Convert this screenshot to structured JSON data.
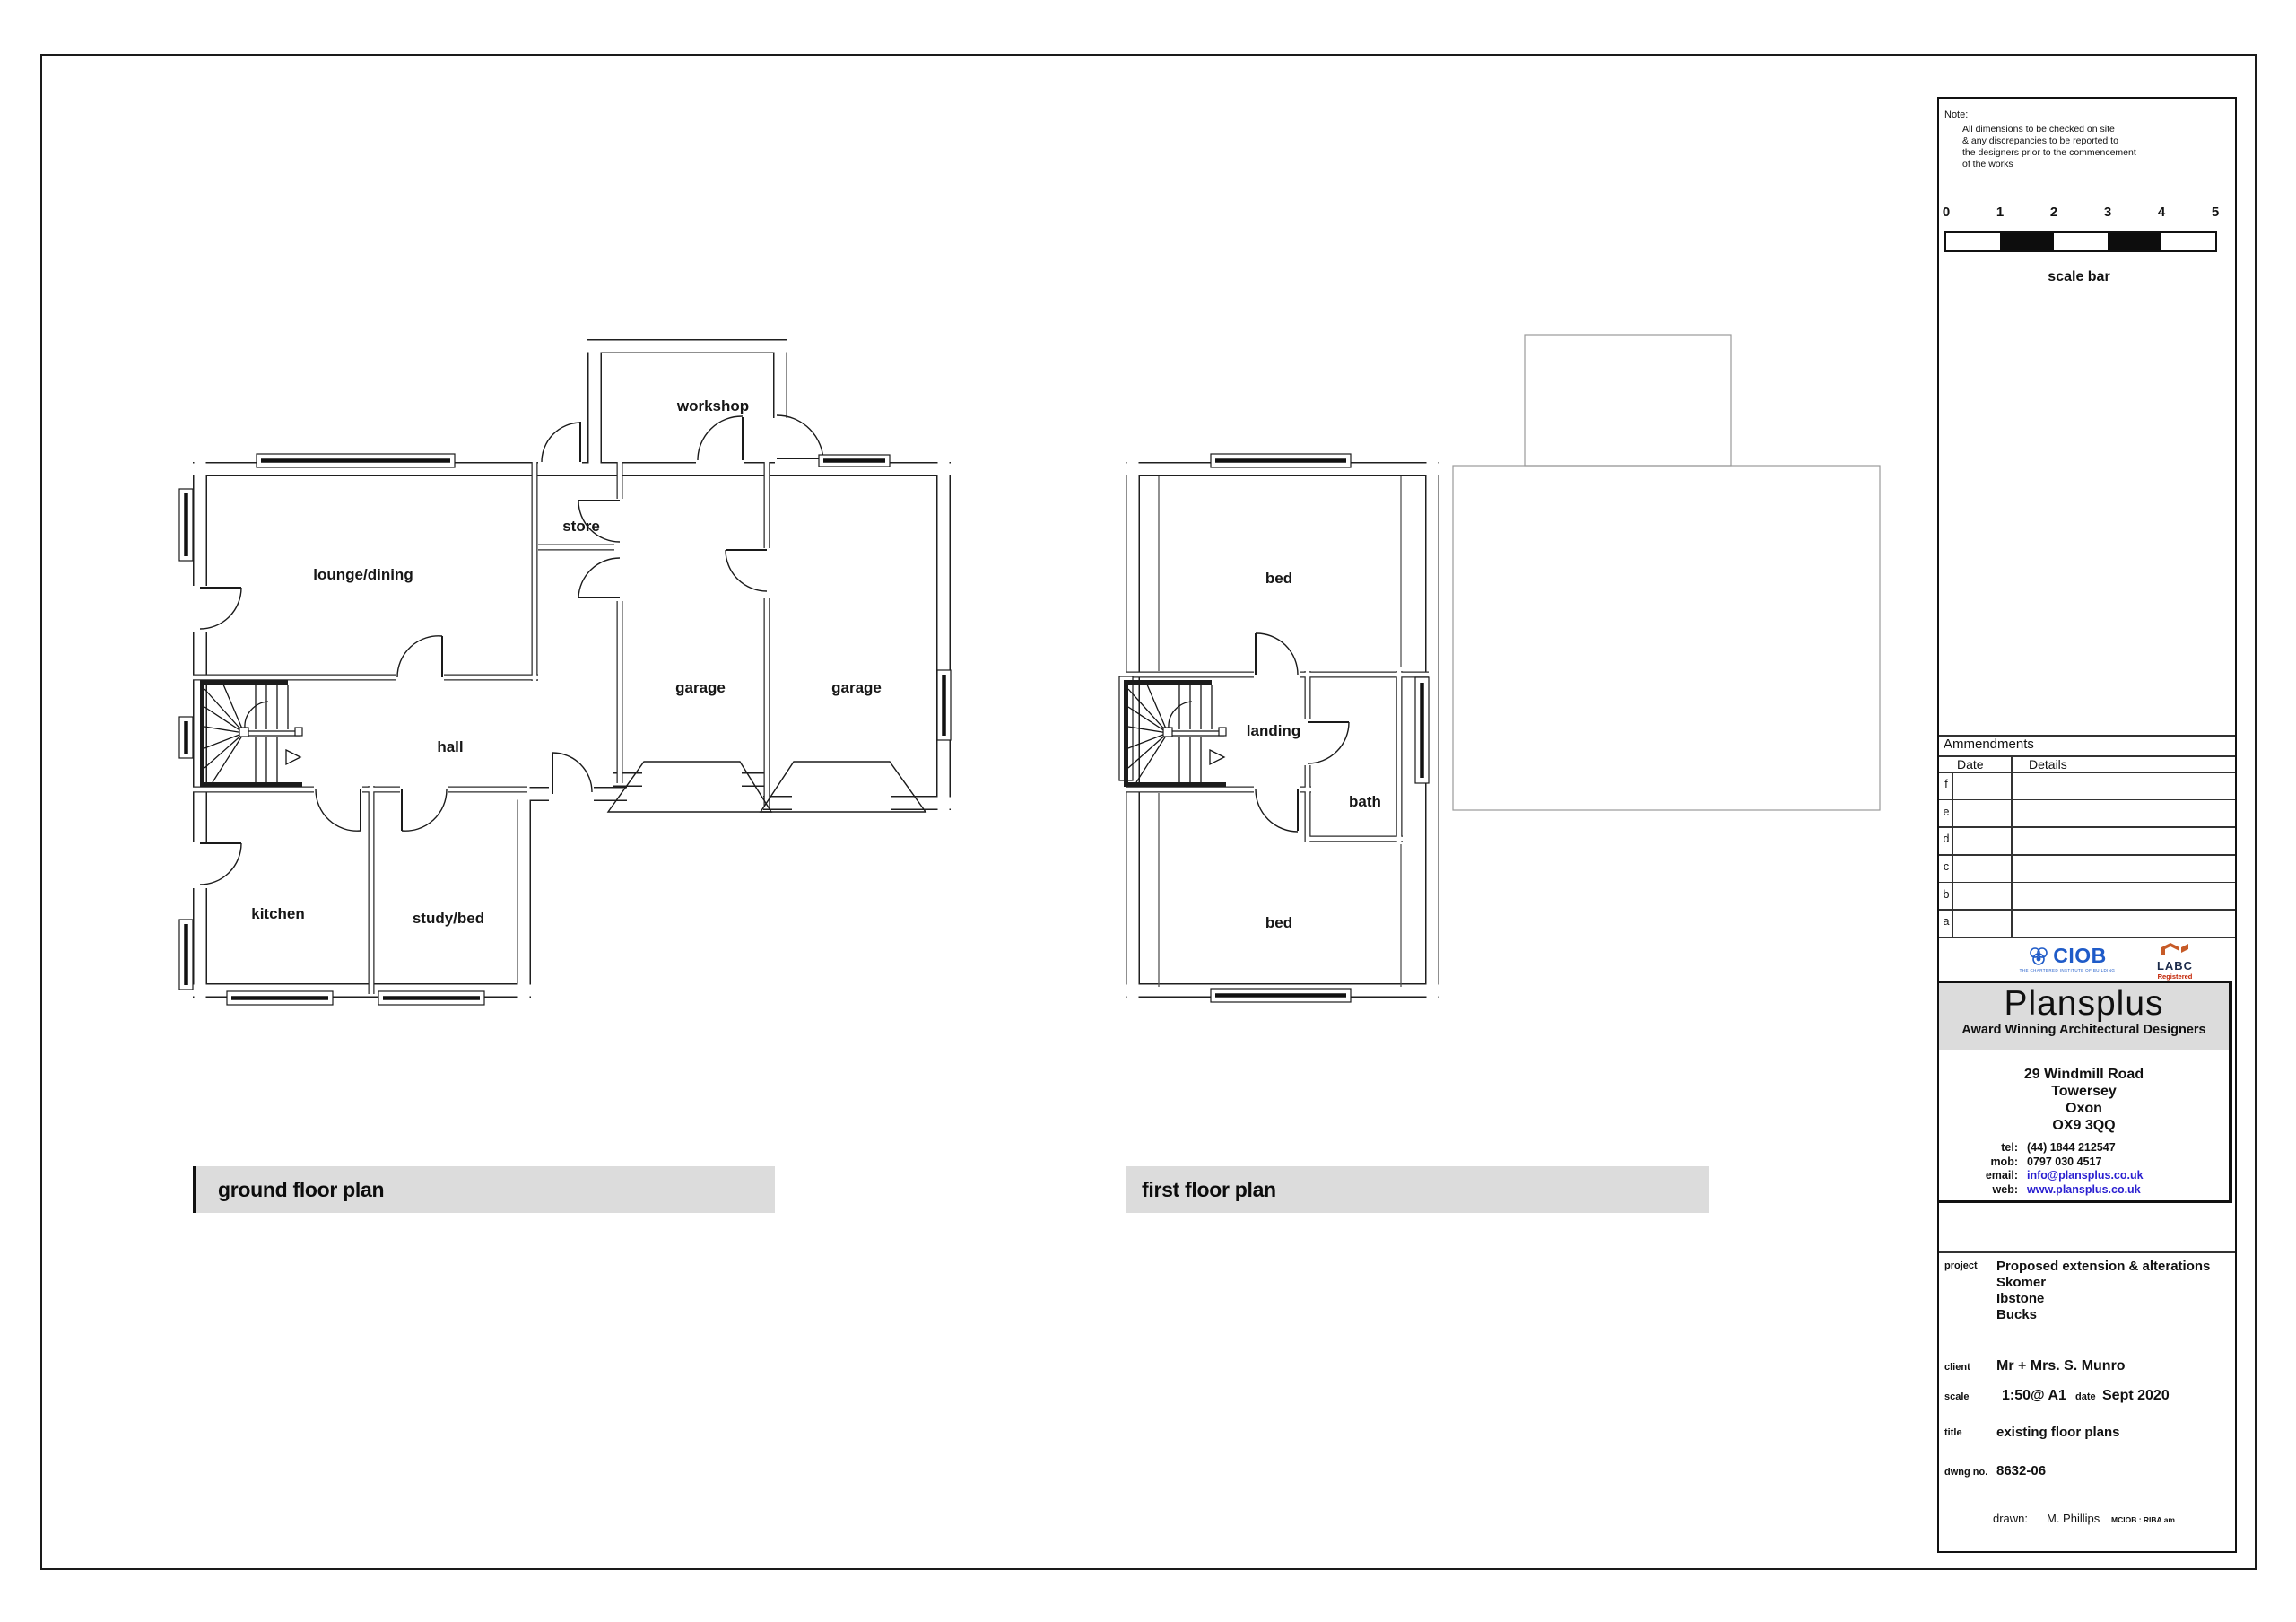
{
  "ground_floor": {
    "title": "ground floor plan",
    "rooms": {
      "lounge_dining": "lounge/dining",
      "workshop": "workshop",
      "store": "store",
      "garage_left": "garage",
      "garage_right": "garage",
      "hall": "hall",
      "kitchen": "kitchen",
      "study_bed": "study/bed"
    }
  },
  "first_floor": {
    "title": "first floor plan",
    "rooms": {
      "bed_top": "bed",
      "landing": "landing",
      "bath": "bath",
      "bed_bottom": "bed"
    }
  },
  "title_block": {
    "note": {
      "label": "Note:",
      "lines": [
        "All dimensions to be checked on site",
        "& any discrepancies to be reported to",
        "the designers prior to the commencement",
        "of the works"
      ]
    },
    "scale_bar": {
      "labels": [
        "0",
        "1",
        "2",
        "3",
        "4",
        "5"
      ],
      "caption": "scale bar"
    },
    "amendments": {
      "heading": "Ammendments",
      "date_header": "Date",
      "details_header": "Details",
      "rows": [
        "f",
        "e",
        "d",
        "c",
        "b",
        "a"
      ]
    },
    "logos": {
      "ciob_text": "CIOB",
      "ciob_caption": "THE CHARTERED INSTITUTE OF BUILDING",
      "labc_text": "LABC",
      "labc_sub": "Registered",
      "labc_caption": "local authority building control"
    },
    "company": {
      "name": "Plansplus",
      "tagline": "Award Winning Architectural Designers",
      "address": [
        "29 Windmill Road",
        "Towersey",
        "Oxon",
        "OX9 3QQ"
      ],
      "tel_label": "tel:",
      "tel": "(44)  1844 212547",
      "mob_label": "mob:",
      "mob": "0797 030 4517",
      "email_label": "email:",
      "email": "info@plansplus.co.uk",
      "web_label": "web:",
      "web": "www.plansplus.co.uk"
    },
    "project": {
      "label": "project",
      "lines": [
        "Proposed extension & alterations",
        "Skomer",
        "Ibstone",
        "Bucks"
      ],
      "client_label": "client",
      "client": "Mr + Mrs. S. Munro",
      "scale_label": "scale",
      "scale": "1:50@ A1",
      "date_label": "date",
      "date": "Sept 2020",
      "title_label": "title",
      "title": "existing floor plans",
      "dwg_label": "dwng no.",
      "dwg": "8632-06",
      "drawn_label": "drawn:",
      "drawn": "M. Phillips",
      "credentials": "MCIOB : RIBA am"
    }
  }
}
